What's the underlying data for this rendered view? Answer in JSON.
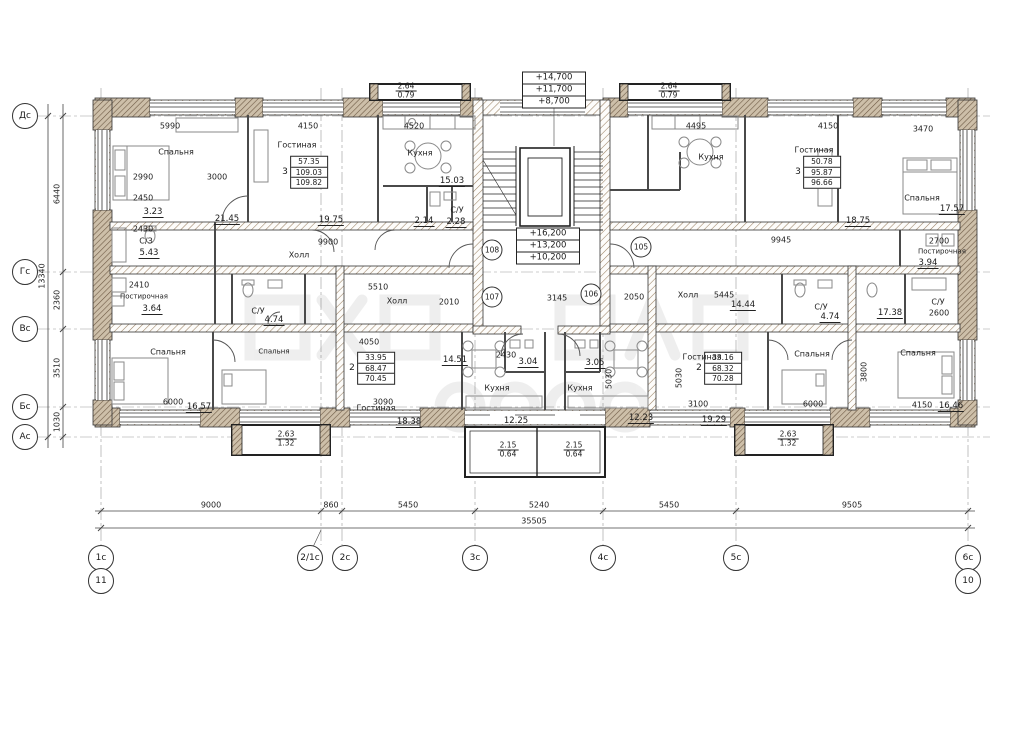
{
  "axes": {
    "left": [
      "Дс",
      "Гс",
      "Вс",
      "Бс",
      "Ас"
    ],
    "bottom": [
      "1с",
      "2/1с",
      "2с",
      "3с",
      "4с",
      "5с",
      "6с"
    ],
    "bottom_extra": [
      "11",
      "10"
    ]
  },
  "dimensions": {
    "bottom_segments": [
      "9000",
      "860",
      "5450",
      "5240",
      "5450",
      "9505"
    ],
    "bottom_total": "35505",
    "left_segments": [
      "6440",
      "2360",
      "3510",
      "1030"
    ],
    "left_total": "13340"
  },
  "elevations": {
    "roof": [
      "+14,700",
      "+11,700",
      "+8,700"
    ],
    "stair": [
      "+16,200",
      "+13,200",
      "+10,200"
    ]
  },
  "units": {
    "u108": "108",
    "u105": "105",
    "u107": "107",
    "u106": "106"
  },
  "stamps": {
    "apt_tl": {
      "rooms": "3",
      "rows": [
        "57.35",
        "109.03",
        "109.82"
      ]
    },
    "apt_tr": {
      "rooms": "3",
      "rows": [
        "50.78",
        "95.87",
        "96.66"
      ]
    },
    "apt_bl": {
      "rooms": "2",
      "rows": [
        "33.95",
        "68.47",
        "70.45"
      ]
    },
    "apt_br": {
      "rooms": "2",
      "rows": [
        "33.16",
        "68.32",
        "70.28"
      ]
    }
  },
  "rooms": {
    "bedroom_tl": {
      "name": "Спальня",
      "area": "21.45"
    },
    "living_tl": {
      "name": "Гостиная",
      "area": "19.75"
    },
    "kitchen_tl": {
      "name": "Кухня",
      "area": "15.03"
    },
    "wc_top_center": {
      "name": "С/У",
      "area": "2.28"
    },
    "sz_left": {
      "name": "С/З",
      "area": "5.43"
    },
    "laundry_left": {
      "name": "Постирочная",
      "area": "3.64"
    },
    "hall_top_left": {
      "name": "Холл"
    },
    "hall_bottom_left": {
      "name": "Холл"
    },
    "hall_bottom_right": {
      "name": "Холл"
    },
    "wc_107": {
      "name": "С/У",
      "area": "4.74"
    },
    "bedroom_bottom_left": {
      "name": "Спальня",
      "area": "16.57"
    },
    "bedroom_107": {
      "name": "Спальня"
    },
    "living_107": {
      "name": "Гостиная",
      "area": "18.38"
    },
    "kitchen_107": {
      "name": "Кухня",
      "area": "12.25"
    },
    "kitchen_106": {
      "name": "Кухня",
      "area": "12.23"
    },
    "living_106": {
      "name": "Гостиная",
      "area": "19.29"
    },
    "bedroom_106": {
      "name": "Спальня"
    },
    "bedroom_bottom_right": {
      "name": "Спальня",
      "area": "16.46"
    },
    "kitchen_tr": {
      "name": "Кухня"
    },
    "living_tr": {
      "name": "Гостиная",
      "area": "18.75"
    },
    "bedroom_tr": {
      "name": "Спальня",
      "area": "17.57"
    },
    "laundry_right": {
      "name": "Постирочная",
      "area": "3.94"
    },
    "wc_106": {
      "name": "С/У",
      "area": "4.74"
    },
    "wc_right": {
      "name": "С/У"
    }
  },
  "misc_areas": {
    "a323": "3.23",
    "a214": "2.14",
    "a304": "3.04",
    "a305": "3.05",
    "a1451": "14.51",
    "a1444": "14.44",
    "a1738": "17.38"
  },
  "inner_dims": {
    "top1": "5990",
    "top2": "4150",
    "top3": "4520",
    "top4": "4495",
    "top5": "4150",
    "top6": "3470",
    "tl1": "2990",
    "tl2": "3000",
    "tl3": "2450",
    "tl4": "2430",
    "tl5": "2410",
    "mid_left": "9900",
    "mid_right": "9945",
    "tr1": "2700",
    "hall_bl_dim": "5510",
    "c1": "2010",
    "c2": "2050",
    "entry": "3145",
    "b0": "4050",
    "b1": "6000",
    "b2": "3090",
    "b3": "3100",
    "b4": "6000",
    "b5": "4150",
    "k1": "2430",
    "v1": "5030",
    "v2": "5030",
    "v3": "3800",
    "r1": "2600",
    "hall_br_dim": "5445"
  },
  "balconies": {
    "top_left": {
      "num": "2.64",
      "den": "0.79"
    },
    "top_right": {
      "num": "2.64",
      "den": "0.79"
    },
    "bottom_left": {
      "num": "2.63",
      "den": "1.32"
    },
    "bottom_center_left": {
      "num": "2.15",
      "den": "0.64"
    },
    "bottom_center_right": {
      "num": "2.15",
      "den": "0.64"
    },
    "bottom_right": {
      "num": "2.63",
      "den": "1.32"
    }
  }
}
